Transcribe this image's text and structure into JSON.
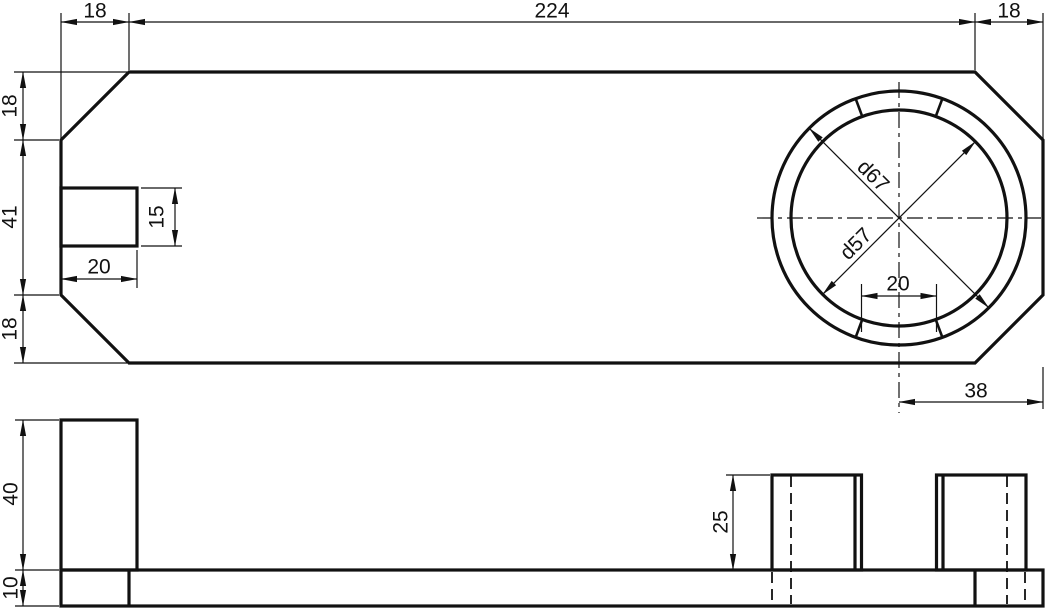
{
  "dimensions": {
    "top": {
      "left_chamfer": "18",
      "middle": "224",
      "right_chamfer": "18"
    },
    "left": {
      "top_chamfer": "18",
      "middle": "41",
      "bottom_chamfer": "18"
    },
    "notch": {
      "width": "20",
      "height": "15"
    },
    "circle": {
      "outer_diameter": "d67",
      "inner_diameter": "d57",
      "tab_gap": "20",
      "offset_from_right": "38"
    },
    "side": {
      "boss_height": "40",
      "plate_thickness": "10",
      "ring_height": "25"
    }
  },
  "colors": {
    "line": "#111111",
    "background": "#ffffff"
  }
}
